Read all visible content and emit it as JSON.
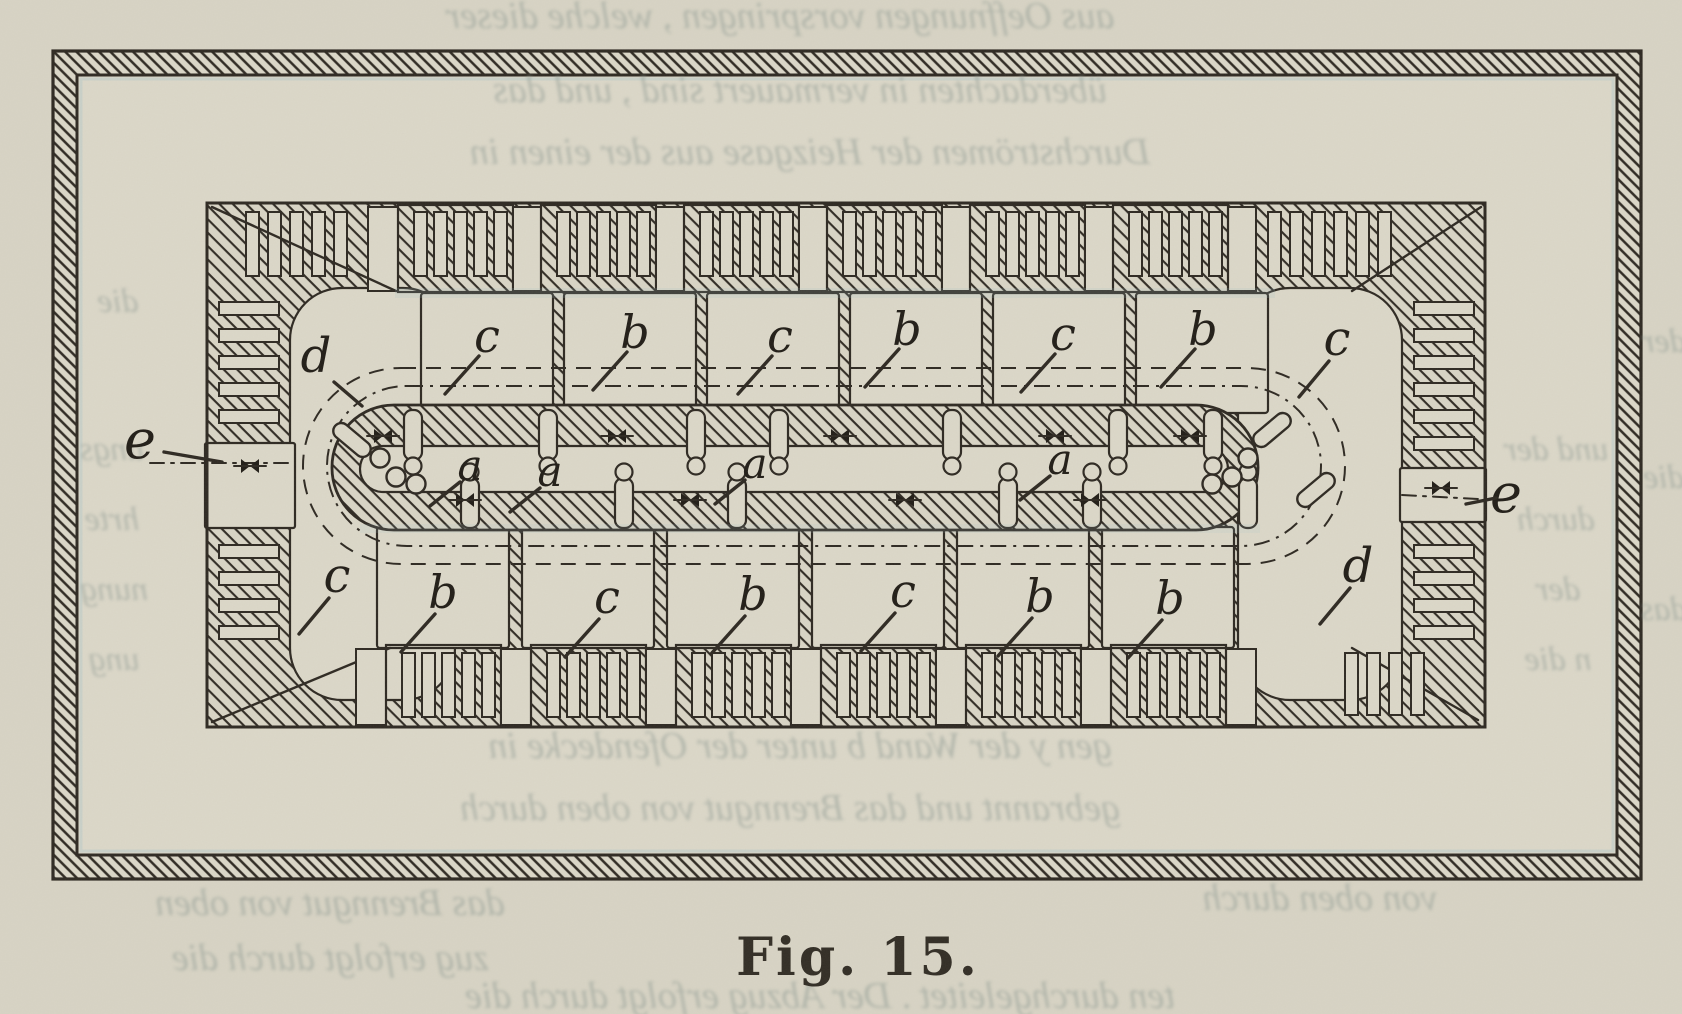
{
  "figure": {
    "caption": "Fig. 15.",
    "labels": {
      "top_row": [
        {
          "text": "c",
          "x": 487,
          "y": 352
        },
        {
          "text": "b",
          "x": 635,
          "y": 348
        },
        {
          "text": "c",
          "x": 780,
          "y": 352
        },
        {
          "text": "b",
          "x": 907,
          "y": 345
        },
        {
          "text": "c",
          "x": 1063,
          "y": 350
        },
        {
          "text": "b",
          "x": 1203,
          "y": 345
        }
      ],
      "bottom_row": [
        {
          "text": "b",
          "x": 443,
          "y": 608
        },
        {
          "text": "c",
          "x": 607,
          "y": 613
        },
        {
          "text": "b",
          "x": 753,
          "y": 610
        },
        {
          "text": "c",
          "x": 903,
          "y": 607
        },
        {
          "text": "b",
          "x": 1040,
          "y": 612
        },
        {
          "text": "b",
          "x": 1170,
          "y": 614
        }
      ],
      "center_duct": [
        {
          "text": "a",
          "x": 470,
          "y": 480
        },
        {
          "text": "a",
          "x": 550,
          "y": 486
        },
        {
          "text": "a",
          "x": 755,
          "y": 478
        },
        {
          "text": "a",
          "x": 1060,
          "y": 474
        }
      ],
      "corner_flues": [
        {
          "text": "d",
          "x": 316,
          "y": 372,
          "dir": "dr"
        },
        {
          "text": "c",
          "x": 1337,
          "y": 355,
          "dir": "dl"
        },
        {
          "text": "c",
          "x": 337,
          "y": 592,
          "dir": "dl"
        },
        {
          "text": "d",
          "x": 1358,
          "y": 582,
          "dir": "dl"
        }
      ],
      "outlets": [
        {
          "text": "e",
          "x": 140,
          "y": 458,
          "side": "left"
        },
        {
          "text": "e",
          "x": 1506,
          "y": 512,
          "side": "right"
        }
      ]
    },
    "ghost_text": {
      "lines": [
        {
          "x": 780,
          "y": 28,
          "size": 38,
          "text": "aus  Oeffnungen      vorspringen ,    welche    dieser"
        },
        {
          "x": 800,
          "y": 102,
          "size": 38,
          "text": "überdachten   in   vermauert   sind ,   und   das"
        },
        {
          "x": 810,
          "y": 164,
          "size": 38,
          "text": "Durchströmen   der   Heizgase   aus   der   einen   in"
        },
        {
          "x": 118,
          "y": 312,
          "size": 34,
          "text": "die"
        },
        {
          "x": 112,
          "y": 460,
          "size": 34,
          "text": "ungs"
        },
        {
          "x": 112,
          "y": 530,
          "size": 34,
          "text": "hrte"
        },
        {
          "x": 114,
          "y": 600,
          "size": 34,
          "text": "nung"
        },
        {
          "x": 114,
          "y": 670,
          "size": 34,
          "text": "ung"
        },
        {
          "x": 1556,
          "y": 460,
          "size": 34,
          "text": "und  der"
        },
        {
          "x": 1556,
          "y": 530,
          "size": 34,
          "text": "durch"
        },
        {
          "x": 1558,
          "y": 600,
          "size": 34,
          "text": "der"
        },
        {
          "x": 1558,
          "y": 670,
          "size": 34,
          "text": "n  die"
        },
        {
          "x": 800,
          "y": 758,
          "size": 38,
          "text": "gen   y   der   Wand   b   unter   der   Ofendecke   in"
        },
        {
          "x": 790,
          "y": 820,
          "size": 38,
          "text": "gebrannt    und   das   Brenngut   von   oben   durch"
        },
        {
          "x": 330,
          "y": 915,
          "size": 38,
          "text": "das   Brenngut   von   oben"
        },
        {
          "x": 330,
          "y": 970,
          "size": 38,
          "text": "zug   erfolgt   durch   die"
        },
        {
          "x": 1320,
          "y": 910,
          "size": 38,
          "text": "von   oben   durch"
        },
        {
          "x": 1664,
          "y": 352,
          "size": 34,
          "text": "der"
        },
        {
          "x": 1664,
          "y": 488,
          "size": 34,
          "text": "die"
        },
        {
          "x": 1664,
          "y": 620,
          "size": 34,
          "text": "das"
        },
        {
          "x": 820,
          "y": 1008,
          "size": 38,
          "text": "ten   durchgeleitet .    Der   Abzug   erfolgt   durch   die"
        }
      ]
    },
    "colors": {
      "paper": "#d8d4c5",
      "paper_inner": "#dcd8c9",
      "ink": "#2e2922",
      "label_ink": "#211d17",
      "ghost": "#8e9a93",
      "caption_ink": "#322d25",
      "halation": "#9fc0c8"
    }
  }
}
